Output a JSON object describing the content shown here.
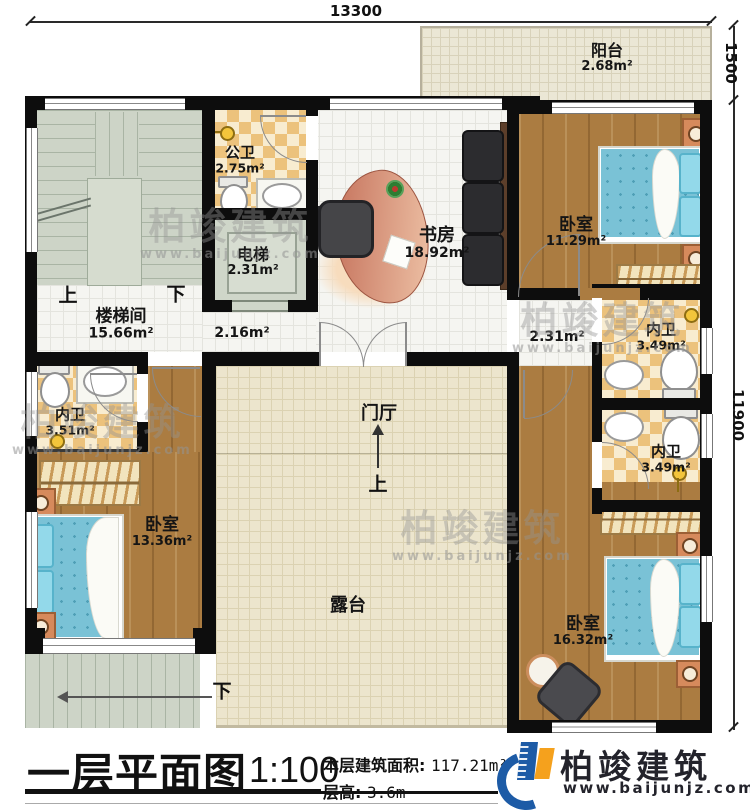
{
  "dimensions": {
    "width_top": "13300",
    "right_upper": "1500",
    "right_lower": "11900"
  },
  "nav": {
    "up": "上",
    "down": "下"
  },
  "rooms": [
    {
      "name": "阳台",
      "area": "2.68m²"
    },
    {
      "name": "公卫",
      "area": "2.75m²"
    },
    {
      "name": "电梯",
      "area": "2.31m²"
    },
    {
      "name": "书房",
      "area": "18.92m²"
    },
    {
      "name": "卧室",
      "area": "11.29m²"
    },
    {
      "name": "楼梯间",
      "area": "15.66m²"
    },
    {
      "area": "2.16m²"
    },
    {
      "area": "2.31m²"
    },
    {
      "name": "内卫",
      "area": "3.49m²"
    },
    {
      "name": "内卫",
      "area": "3.51m²"
    },
    {
      "name": "卧室",
      "area": "13.36m²"
    },
    {
      "name": "门厅"
    },
    {
      "name": "内卫",
      "area": "3.49m²"
    },
    {
      "name": "露台"
    },
    {
      "name": "卧室",
      "area": "16.32m²"
    }
  ],
  "title": {
    "main": "一层平面图",
    "scale": "1:100",
    "area_label": "本层建筑面积:",
    "area_value": "117.21m²",
    "floor_height_label": "层高:",
    "floor_height_value": "3.6m"
  },
  "brand": {
    "name": "柏竣建筑",
    "url": "www.baijunjz.com"
  },
  "watermark": {
    "name": "柏竣建筑",
    "url": "www.baijunjz.com"
  },
  "colors": {
    "wall": "#0d0d0d",
    "wood": "#ab7c41",
    "tile_checker": "#ecc27c",
    "bed": "#7ac2d6",
    "stair": "#cdd4c7",
    "terrace": "#ece5cd",
    "logo_blue": "#1d5ba6",
    "logo_orange": "#f5a11d"
  }
}
